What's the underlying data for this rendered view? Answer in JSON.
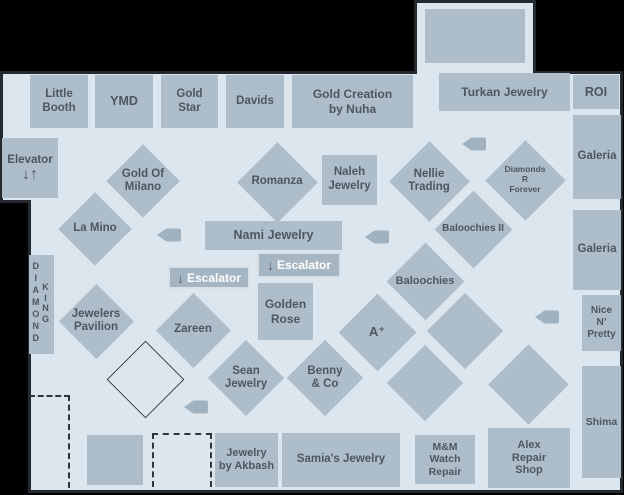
{
  "colors": {
    "floor": "#dce6ee",
    "outline": "#23292e",
    "room_fill": "#aebdca",
    "room_text": "#4d5761",
    "escalator_fill": "#a5b5c2",
    "escalator_border": "#d8e0e7",
    "escalator_text": "#ffffff",
    "escalator_arrow": "#57616b",
    "camera": "#a0b1bf",
    "vacant_outline": "#39424a"
  },
  "rooms": [
    {
      "id": "little-booth",
      "label": "Little\nBooth",
      "x": 30,
      "y": 75,
      "w": 58,
      "h": 53
    },
    {
      "id": "ymd",
      "label": "YMD",
      "x": 95,
      "y": 75,
      "w": 58,
      "h": 53,
      "font": 12.5
    },
    {
      "id": "gold-star",
      "label": "Gold\nStar",
      "x": 161,
      "y": 75,
      "w": 57,
      "h": 53
    },
    {
      "id": "davids",
      "label": "Davids",
      "x": 226,
      "y": 75,
      "w": 58,
      "h": 53
    },
    {
      "id": "gold-creation-by-nuha",
      "label": "Gold Creation\nby Nuha",
      "x": 292,
      "y": 75,
      "w": 121,
      "h": 53,
      "font": 12
    },
    {
      "id": "turkan-jewelry",
      "label": "Turkan Jewelry",
      "x": 439,
      "y": 73,
      "w": 131,
      "h": 38,
      "font": 12
    },
    {
      "id": "roi",
      "label": "ROI",
      "x": 573,
      "y": 75,
      "w": 46,
      "h": 34,
      "font": 12.5
    },
    {
      "id": "galeria-upper",
      "label": "Galeria",
      "x": 573,
      "y": 115,
      "w": 48,
      "h": 84
    },
    {
      "id": "galeria-lower",
      "label": "Galeria",
      "x": 573,
      "y": 210,
      "w": 48,
      "h": 80
    },
    {
      "id": "nice-n-pretty",
      "label": "Nice\nN’\nPretty",
      "x": 582,
      "y": 295,
      "w": 39,
      "h": 56,
      "font": 10
    },
    {
      "id": "shima",
      "label": "Shima",
      "x": 582,
      "y": 366,
      "w": 39,
      "h": 112,
      "font": 10.5
    },
    {
      "id": "naleh-jewelry",
      "label": "Naleh\nJewelry",
      "x": 322,
      "y": 155,
      "w": 55,
      "h": 50
    },
    {
      "id": "nami-jewelry",
      "label": "Nami Jewelry",
      "x": 205,
      "y": 221,
      "w": 137,
      "h": 29,
      "font": 12.5
    },
    {
      "id": "golden-rose",
      "label": "Golden\nRose",
      "x": 258,
      "y": 283,
      "w": 55,
      "h": 57,
      "font": 12
    },
    {
      "id": "upper-vacant-room",
      "label": "",
      "x": 425,
      "y": 9,
      "w": 100,
      "h": 54
    },
    {
      "id": "lower-vacant-room",
      "label": "",
      "x": 87,
      "y": 435,
      "w": 56,
      "h": 50
    },
    {
      "id": "jewelry-by-akbash",
      "label": "Jewelry\nby Akbash",
      "x": 215,
      "y": 433,
      "w": 63,
      "h": 54,
      "font": 11
    },
    {
      "id": "samias-jewelry",
      "label": "Samia's Jewelry",
      "x": 282,
      "y": 433,
      "w": 118,
      "h": 54
    },
    {
      "id": "mm-watch-repair",
      "label": "M&M\nWatch\nRepair",
      "x": 415,
      "y": 435,
      "w": 60,
      "h": 49,
      "font": 10.5
    },
    {
      "id": "alex-repair-shop",
      "label": "Alex\nRepair\nShop",
      "x": 488,
      "y": 428,
      "w": 82,
      "h": 60,
      "font": 11
    }
  ],
  "diamond_rooms": [
    {
      "id": "gold-of-milano",
      "label": "Gold Of\nMilano",
      "cx": 143,
      "cy": 181,
      "size": 52
    },
    {
      "id": "la-mino",
      "label": "La Mino",
      "cx": 95,
      "cy": 229,
      "size": 52
    },
    {
      "id": "romanza",
      "label": "Romanza",
      "cx": 277,
      "cy": 182,
      "size": 57
    },
    {
      "id": "nellie-trading",
      "label": "Nellie\nTrading",
      "cx": 429,
      "cy": 181,
      "size": 57
    },
    {
      "id": "diamonds-r-forever",
      "label": "Diamonds\nR\nForever",
      "cx": 525,
      "cy": 180,
      "size": 57,
      "font": 8.5,
      "lw": 60
    },
    {
      "id": "baloochies-ii",
      "label": "Baloochies II",
      "cx": 473,
      "cy": 229,
      "size": 55,
      "font": 10,
      "lw": 90
    },
    {
      "id": "baloochies",
      "label": "Baloochies",
      "cx": 425,
      "cy": 281,
      "size": 55,
      "font": 11,
      "lw": 80
    },
    {
      "id": "a-plus",
      "label": "A⁺",
      "cx": 377,
      "cy": 332,
      "size": 55,
      "font": 13
    },
    {
      "id": "jewelers-pavilion",
      "label": "Jewelers\nPavilion",
      "cx": 96,
      "cy": 321,
      "size": 53
    },
    {
      "id": "zareen",
      "label": "Zareen",
      "cx": 193,
      "cy": 330,
      "size": 53
    },
    {
      "id": "sean-jewelry",
      "label": "Sean\nJewelry",
      "cx": 246,
      "cy": 378,
      "size": 54
    },
    {
      "id": "benny-and-co",
      "label": "Benny\n& Co",
      "cx": 325,
      "cy": 378,
      "size": 54
    },
    {
      "id": "vacant-diamond-a",
      "label": "",
      "cx": 465,
      "cy": 331,
      "size": 54
    },
    {
      "id": "vacant-diamond-b",
      "label": "",
      "cx": 425,
      "cy": 383,
      "size": 54
    },
    {
      "id": "vacant-diamond-c",
      "label": "",
      "cx": 528,
      "cy": 384,
      "size": 57
    }
  ],
  "vacant_outline_diamond": {
    "cx": 145,
    "cy": 379,
    "size": 55
  },
  "escalators": [
    {
      "label": "Escalator",
      "arrow": "↓",
      "x": 257,
      "y": 252,
      "w": 84,
      "h": 26
    },
    {
      "label": "Escalator",
      "arrow": "↓",
      "x": 168,
      "y": 266,
      "w": 82,
      "h": 23
    }
  ],
  "elevator": {
    "label": "Elevator",
    "arrows": "↓↑",
    "x": 2,
    "y": 138,
    "w": 56,
    "h": 60
  },
  "diamond_king": {
    "word1": "DIAMOND",
    "word2": "KING",
    "x": 29,
    "y": 255,
    "w": 25,
    "h": 99
  },
  "cameras": [
    {
      "cx": 169,
      "cy": 235
    },
    {
      "cx": 377,
      "cy": 237
    },
    {
      "cx": 474,
      "cy": 144
    },
    {
      "cx": 547,
      "cy": 317
    },
    {
      "cx": 196,
      "cy": 407
    }
  ],
  "vacant_dashed": [
    {
      "x": 29,
      "y": 395,
      "w": 41,
      "h": 93,
      "sides": [
        "top",
        "right"
      ]
    },
    {
      "x": 152,
      "y": 433,
      "w": 60,
      "h": 54,
      "sides": [
        "top",
        "left",
        "right"
      ]
    }
  ]
}
